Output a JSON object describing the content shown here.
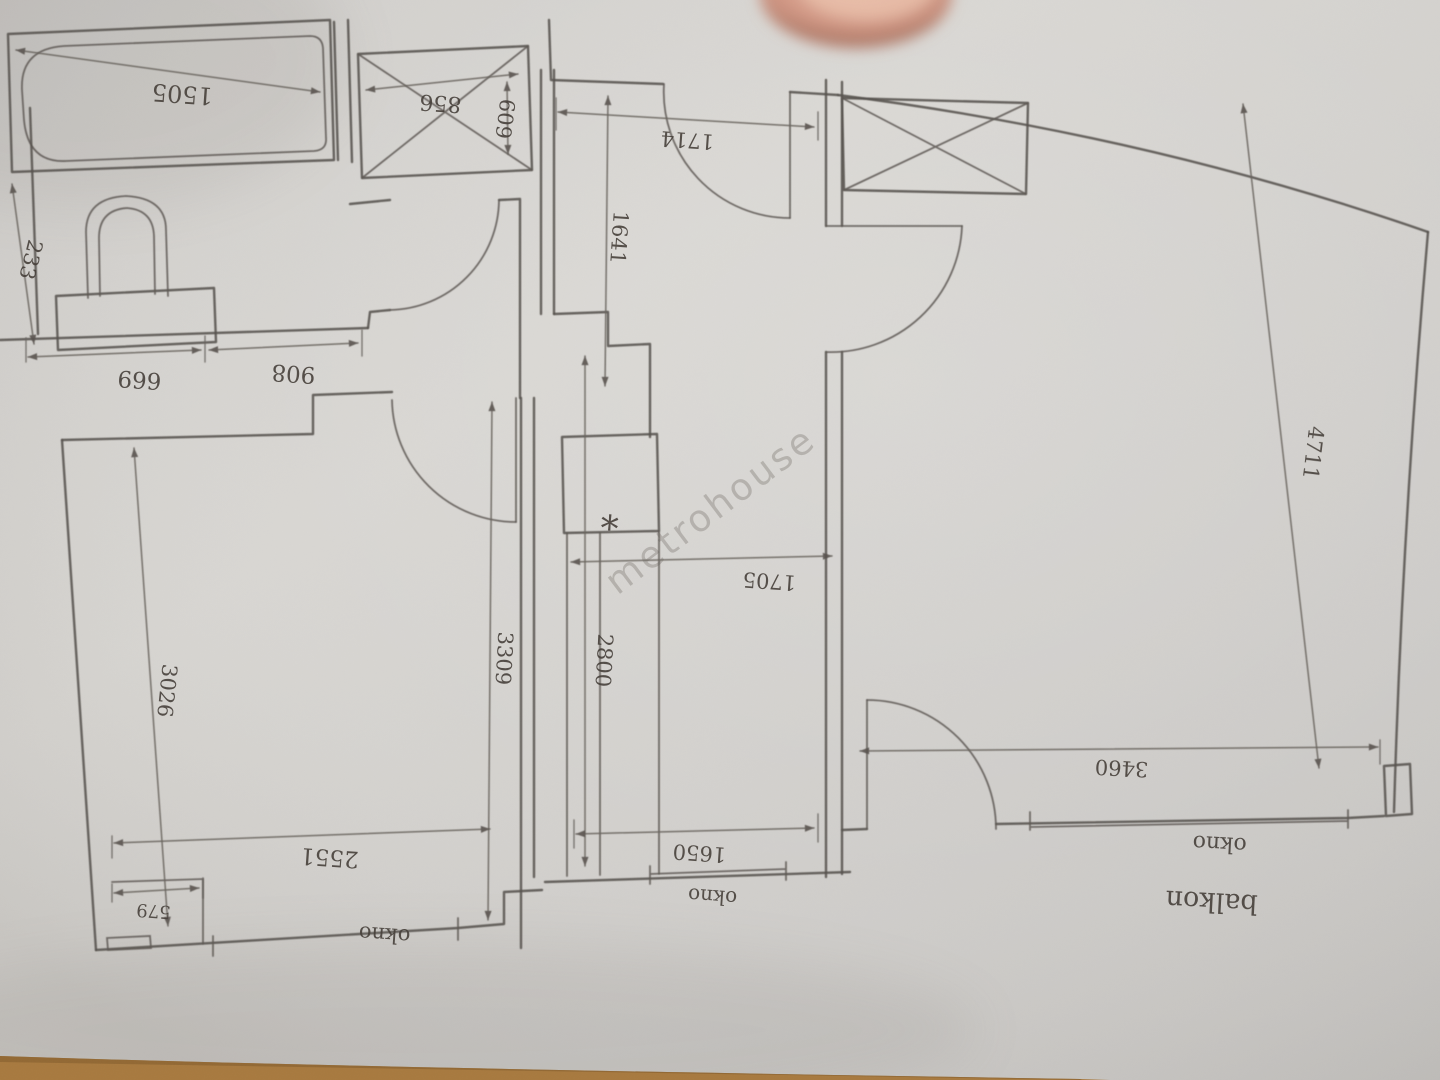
{
  "scene": {
    "watermark": "metrohouse",
    "paper_color": "#d4d2ce",
    "table_edge_color": "#a87a3f",
    "ink_color": "#57524d"
  },
  "plan": {
    "labels": {
      "balcony": "balkon",
      "window": "okno",
      "fixture_mark": "*"
    },
    "dimensions_mm": {
      "bathtub_length": "1505",
      "bath_side": "233",
      "shaft_width": "856",
      "shaft_depth": "609",
      "bath_wall_left": "669",
      "bath_wall_right": "908",
      "entry_wall": "1714",
      "hall_depth": "1641",
      "left_room_wall_upper": "3026",
      "left_room_width": "2551",
      "left_room_height": "3309",
      "left_room_notch": "579",
      "corridor_depth": "2800",
      "corridor_width": "1705",
      "corridor_window": "1650",
      "right_room_depth": "4711",
      "right_room_window": "3460"
    }
  }
}
